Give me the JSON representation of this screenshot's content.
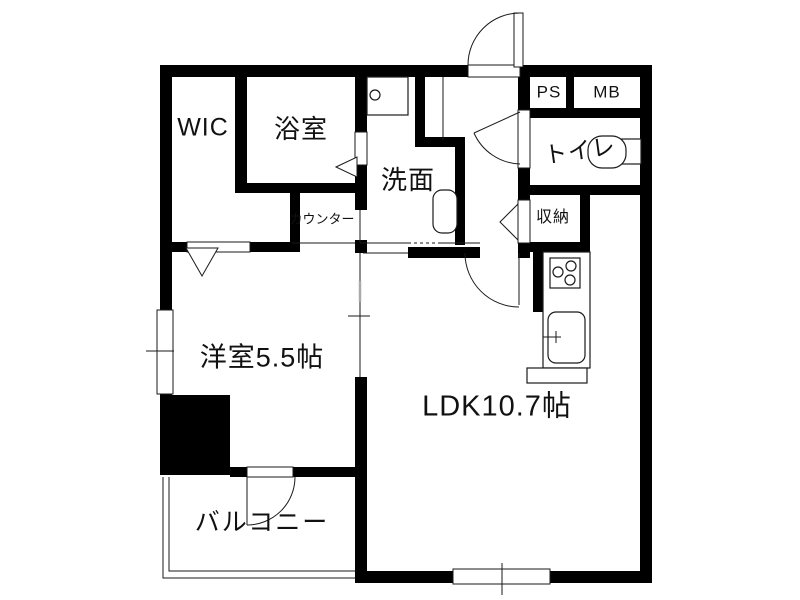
{
  "colors": {
    "wall": "#000000",
    "bg": "#ffffff",
    "line": "#1a1a1a",
    "gray": "#aaaaaa"
  },
  "rooms": {
    "wic": {
      "label": "WIC"
    },
    "bathroom": {
      "label": "浴室"
    },
    "washroom": {
      "label": "洗面"
    },
    "counter": {
      "label": "カウンター"
    },
    "pipe_space": {
      "label": "PS"
    },
    "meter_box": {
      "label": "MB"
    },
    "toilet": {
      "label": "トイレ"
    },
    "storage": {
      "label": "収納"
    },
    "western_room": {
      "label": "洋室5.5帖",
      "size_tatami": 5.5
    },
    "ldk": {
      "label": "LDK10.7帖",
      "size_tatami": 10.7
    },
    "balcony": {
      "label": "バルコニー"
    }
  },
  "fixtures": [
    "entrance-door",
    "kitchen-stove",
    "kitchen-sink",
    "wash-basin",
    "toilet-bowl",
    "washing-machine-pan",
    "sliding-partition",
    "balcony-door",
    "bath-folding-door",
    "storage-folding-door",
    "wic-folding-door"
  ]
}
